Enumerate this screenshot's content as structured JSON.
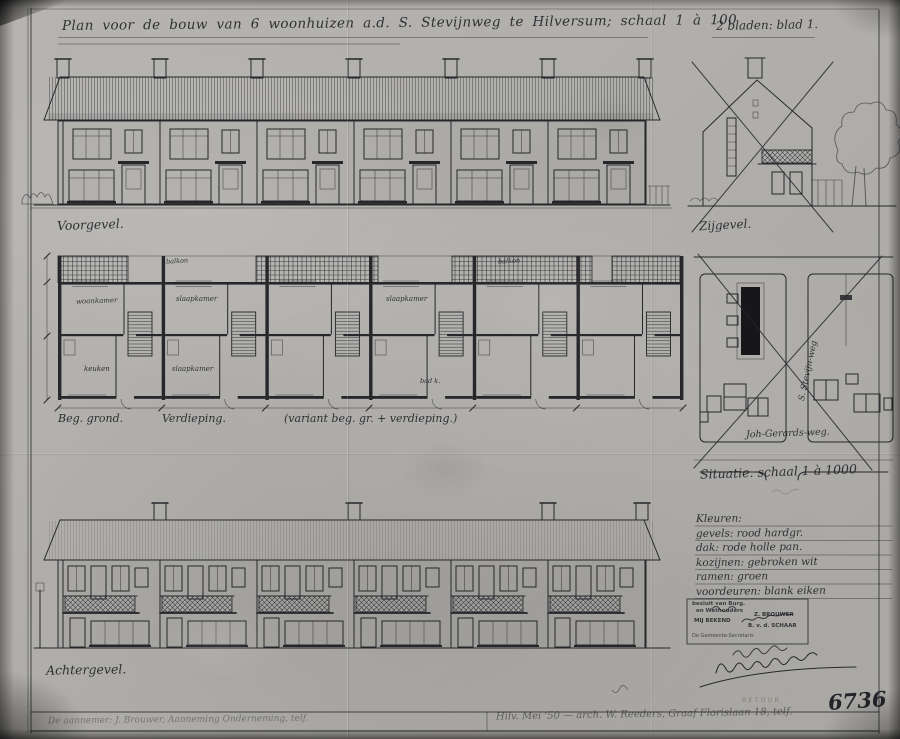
{
  "colors": {
    "paper": "#b3b1ad",
    "ink": "#20202a",
    "pencil": "#5a564e"
  },
  "sheet": {
    "title": "Plan voor de bouw van 6 woonhuizen a.d. S. Stevijnweg te Hilversum; schaal 1 à 100",
    "pages_note": "2 bladen: blad 1.",
    "drawing_number": "6736",
    "retour_mark": "RETOUR"
  },
  "elevations": {
    "front_label": "Voorgevel.",
    "side_label": "Zijgevel.",
    "rear_label": "Achtergevel."
  },
  "plans": {
    "ground_label": "Beg. grond.",
    "floor_label": "Verdieping.",
    "variant_label": "(variant beg. gr. + verdieping.)",
    "rooms": {
      "r1": "woonkamer",
      "r2": "keuken",
      "r3": "slaapkamer",
      "r4": "slaapkamer",
      "r5": "slaapkamer",
      "r6": "bad k.",
      "r7": "balkon",
      "r8": "balkon"
    }
  },
  "situation": {
    "caption": "Situatie. schaal 1 à 1000",
    "street_horizontal": "Joh-Gerards-weg.",
    "street_vertical": "S. Stevijn-weg"
  },
  "legend": {
    "heading": "Kleuren:",
    "items": [
      "gevels: rood hardgr.",
      "dak: rode holle pan.",
      "kozijnen: gebroken wit",
      "ramen: groen",
      "voordeuren: blank eiken"
    ]
  },
  "stamp": {
    "line1": "besluit van Burg.",
    "line2": "en Wethouders",
    "line3": "MIJ BEKEND",
    "name1": "Z. BROUWER",
    "name2": "B. v. d. SCHAAR",
    "line4": "De Gemeente-Secretaris"
  },
  "footer": {
    "left_note": "De aannemer: J. Brouwer, Aanneming Onderneming, telf.",
    "right_note": "Hilv. Mei '50 — arch. W. Reeders, Graaf Florislaan 18, telf."
  }
}
